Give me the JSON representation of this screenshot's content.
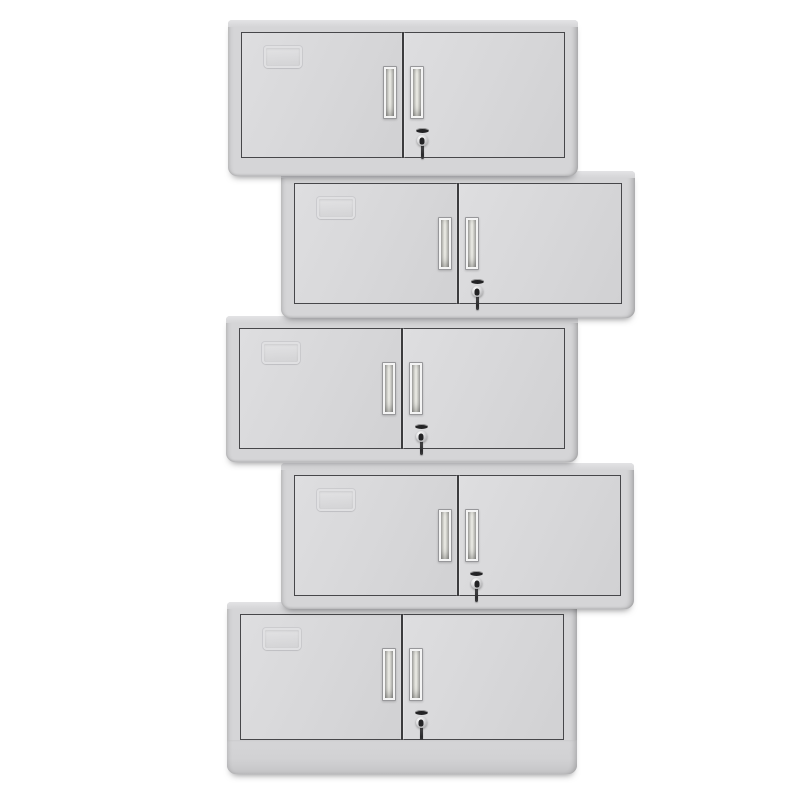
{
  "scene": {
    "description": "Product photo: five identical light-gray two-door steel wall cabinets stacked vertically in an alternating left/right zigzag on a plain white background. Each cabinet has a recessed card label holder on the left door, two vertical recessed handles flanking the center seam, and a chrome key lock with key inserted on the right door. The bottom unit has a taller plinth base.",
    "unit_count": 5,
    "background_color": "#ffffff",
    "palette": {
      "background": "#ffffff",
      "body": "#d5d5d7",
      "top_lip": "#e3e3e5",
      "door_light": "#dedee0",
      "door_dark": "#d1d1d3",
      "door_border": "#47474a",
      "seam": "#3c3c3e",
      "handle_frame": "#f4f4f4",
      "handle_recess_light": "#efefe9",
      "handle_recess_dark": "#a4a4a2",
      "lock_chrome": "#d9d9db",
      "lock_dark": "#232325"
    },
    "cabinets": [
      {
        "id": "cabinet-unit-1",
        "position": "top, aligned left",
        "left": 228,
        "top": 20,
        "width": 350,
        "height": 156,
        "door_bottom_margin": 18,
        "base_height": 0,
        "z": 5
      },
      {
        "id": "cabinet-unit-2",
        "position": "second, offset right",
        "left": 281,
        "top": 171,
        "width": 354,
        "height": 147,
        "door_bottom_margin": 14,
        "base_height": 0,
        "z": 4
      },
      {
        "id": "cabinet-unit-3",
        "position": "middle, aligned left",
        "left": 226,
        "top": 316,
        "width": 352,
        "height": 146,
        "door_bottom_margin": 13,
        "base_height": 0,
        "z": 3
      },
      {
        "id": "cabinet-unit-4",
        "position": "fourth, offset right",
        "left": 281,
        "top": 463,
        "width": 353,
        "height": 146,
        "door_bottom_margin": 13,
        "base_height": 0,
        "z": 2
      },
      {
        "id": "cabinet-unit-5",
        "position": "bottom, aligned left, taller plinth base",
        "left": 227,
        "top": 602,
        "width": 350,
        "height": 172,
        "door_bottom_margin": 34,
        "base_height": 34,
        "z": 1
      }
    ],
    "cabinet_features": {
      "doors": [
        "left door",
        "right door"
      ],
      "label_holder": "embossed card holder on upper-left of left door",
      "handles": "two vertical recessed handles beside center seam",
      "lock": "chrome cylinder lock with inserted key on right door below handle"
    }
  }
}
